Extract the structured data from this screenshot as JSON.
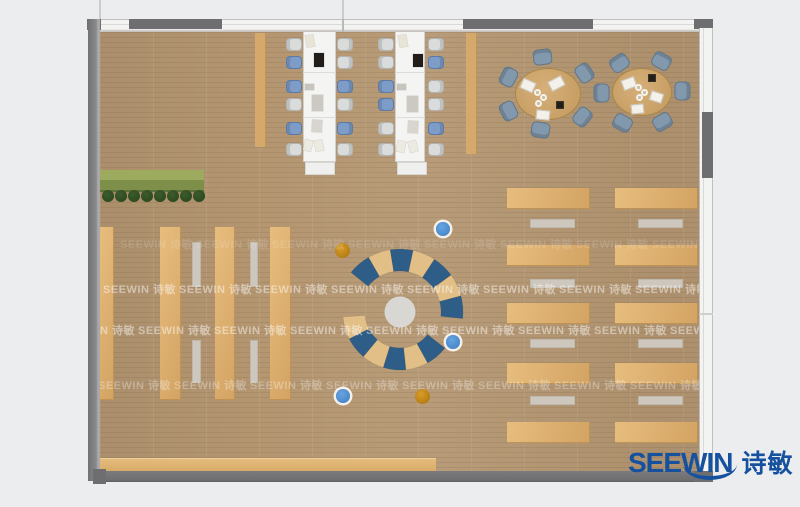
{
  "branding": {
    "logo": {
      "en": "SEEWIN",
      "cn": "诗敏",
      "color": "#15519f"
    },
    "watermark": {
      "text": "SEEWIN 诗敏"
    }
  },
  "palette": {
    "floor": "#b49671",
    "wall_dark": "#6e6e71",
    "window_white": "#f3f3f2",
    "wood_furniture": "#deb170",
    "bench_gray": "#cdc7bd",
    "table_white": "#f4f4f3",
    "chair_blue": "#7e9cc8",
    "chair_gray": "#dadcdb",
    "round_chair_slate": "#8299ad",
    "round_table_tan": "#cfa76f",
    "arc_blue": "#2e5d88",
    "arc_tan": "#e2bf86",
    "center_rug": "#d8d7d3",
    "dot_blue": "#4a8ed2",
    "dot_orange": "#c8860d",
    "planter_green": "#9cab5e",
    "plant_dark": "#27421d"
  },
  "watermark_rows": [
    {
      "y": 236,
      "x0": 120,
      "step": 76,
      "count": 8,
      "opacity": 0.14
    },
    {
      "y": 281,
      "x0": 103,
      "step": 76,
      "count": 8,
      "opacity": 0.46
    },
    {
      "y": 322,
      "x0": 62,
      "step": 76,
      "count": 9,
      "opacity": 0.46
    },
    {
      "y": 377,
      "x0": 98,
      "step": 76,
      "count": 8,
      "opacity": 0.3
    }
  ],
  "furniture": {
    "planter": {
      "x": 100,
      "y": 170,
      "w": 104,
      "h": 22,
      "top": "#9cab5e",
      "bottom": "#7e8f49",
      "edge": "#5f7038"
    },
    "plants": {
      "y": 196,
      "r": 6,
      "xs": [
        108,
        121,
        134,
        147,
        160,
        173,
        186,
        199
      ]
    },
    "shelf_columns": [
      {
        "x": 99,
        "y": 227,
        "w": 15,
        "h": 173
      },
      {
        "x": 160,
        "y": 227,
        "w": 21,
        "h": 173
      },
      {
        "x": 215,
        "y": 227,
        "w": 20,
        "h": 173
      },
      {
        "x": 270,
        "y": 227,
        "w": 21,
        "h": 173
      }
    ],
    "bench_strips": [
      {
        "x": 192,
        "y": 242,
        "w": 9,
        "h": 45
      },
      {
        "x": 250,
        "y": 242,
        "w": 8,
        "h": 45
      },
      {
        "x": 192,
        "y": 340,
        "w": 9,
        "h": 43
      },
      {
        "x": 250,
        "y": 340,
        "w": 8,
        "h": 43
      }
    ],
    "top_strips": [
      {
        "x": 255,
        "y": 33,
        "w": 11,
        "h": 114
      },
      {
        "x": 466,
        "y": 33,
        "w": 11,
        "h": 121
      }
    ],
    "bottom_bench": {
      "x": 100,
      "y": 458,
      "w": 336,
      "h": 13
    },
    "desk_columns": [
      {
        "desk_x": 507,
        "desk_w": 83,
        "strip_x": 530,
        "strip_w": 45
      },
      {
        "desk_x": 615,
        "desk_w": 83,
        "strip_x": 638,
        "strip_w": 45
      }
    ],
    "desk_row_ys": [
      188,
      245,
      303,
      363,
      422
    ],
    "desk_h": 21,
    "strip_row_ys": [
      219,
      279,
      339,
      396
    ],
    "strip_h": 9,
    "long_tables": [
      {
        "x": 303,
        "y": 31,
        "w": 33,
        "h": 131,
        "seams": [
          72,
          117
        ],
        "cap": {
          "x": 305,
          "y": 162,
          "w": 30,
          "h": 13
        },
        "chair_ys": [
          44,
          62,
          86,
          104,
          128,
          149
        ],
        "left_cx": 294,
        "right_cx": 345,
        "left_colors": [
          "gray",
          "blue",
          "blue",
          "gray",
          "blue",
          "gray"
        ],
        "right_colors": [
          "gray",
          "gray",
          "blue",
          "gray",
          "blue",
          "gray"
        ],
        "items": [
          {
            "x": 306,
            "y": 35,
            "w": 8,
            "h": 12,
            "c": "#e8e4d6",
            "r": -10
          },
          {
            "x": 314,
            "y": 53,
            "w": 10,
            "h": 14,
            "c": "#221d18",
            "r": 0
          },
          {
            "x": 305,
            "y": 84,
            "w": 9,
            "h": 6,
            "c": "#c7c4be",
            "r": 0
          },
          {
            "x": 312,
            "y": 95,
            "w": 11,
            "h": 16,
            "c": "#ccc9c3",
            "r": 0
          },
          {
            "x": 312,
            "y": 120,
            "w": 10,
            "h": 12,
            "c": "#d8d5cf",
            "r": 3
          },
          {
            "x": 304,
            "y": 140,
            "w": 8,
            "h": 11,
            "c": "#edebe1",
            "r": 14
          },
          {
            "x": 315,
            "y": 140,
            "w": 8,
            "h": 11,
            "c": "#edebe1",
            "r": -12
          }
        ]
      },
      {
        "x": 395,
        "y": 31,
        "w": 30,
        "h": 131,
        "seams": [
          72,
          117
        ],
        "cap": {
          "x": 397,
          "y": 162,
          "w": 30,
          "h": 13
        },
        "chair_ys": [
          44,
          62,
          86,
          104,
          128,
          149
        ],
        "left_cx": 386,
        "right_cx": 436,
        "left_colors": [
          "gray",
          "gray",
          "blue",
          "blue",
          "gray",
          "gray"
        ],
        "right_colors": [
          "gray",
          "blue",
          "gray",
          "gray",
          "blue",
          "gray"
        ],
        "items": [
          {
            "x": 399,
            "y": 35,
            "w": 8,
            "h": 12,
            "c": "#e8e4d6",
            "r": -10
          },
          {
            "x": 413,
            "y": 54,
            "w": 10,
            "h": 13,
            "c": "#221d18",
            "r": 0
          },
          {
            "x": 397,
            "y": 84,
            "w": 9,
            "h": 6,
            "c": "#c7c4be",
            "r": 0
          },
          {
            "x": 407,
            "y": 96,
            "w": 11,
            "h": 16,
            "c": "#ccc9c3",
            "r": 0
          },
          {
            "x": 408,
            "y": 121,
            "w": 10,
            "h": 12,
            "c": "#d8d5cf",
            "r": 3
          },
          {
            "x": 397,
            "y": 141,
            "w": 8,
            "h": 11,
            "c": "#edebe1",
            "r": 12
          },
          {
            "x": 409,
            "y": 141,
            "w": 8,
            "h": 11,
            "c": "#edebe1",
            "r": -14
          }
        ]
      }
    ],
    "round_tables": [
      {
        "cx": 548,
        "cy": 94,
        "rx": 33,
        "ry": 26,
        "chair_angles": [
          97,
          153,
          207,
          260,
          321,
          34
        ],
        "papers": [
          {
            "x": 521,
            "y": 80,
            "w": 14,
            "h": 11,
            "r": 24
          },
          {
            "x": 549,
            "y": 78,
            "w": 15,
            "h": 11,
            "r": -28
          },
          {
            "x": 536,
            "y": 110,
            "w": 14,
            "h": 10,
            "r": 6
          }
        ],
        "cups": [
          [
            537,
            92
          ],
          [
            543,
            97
          ],
          [
            538,
            103
          ]
        ],
        "dark": {
          "x": 556,
          "y": 101,
          "w": 8,
          "h": 8
        }
      },
      {
        "cx": 642,
        "cy": 92,
        "rx": 30,
        "ry": 24,
        "chair_angles": [
          124,
          61,
          181,
          1,
          241,
          300
        ],
        "papers": [
          {
            "x": 622,
            "y": 78,
            "w": 14,
            "h": 11,
            "r": -20
          },
          {
            "x": 650,
            "y": 92,
            "w": 13,
            "h": 10,
            "r": 18
          },
          {
            "x": 631,
            "y": 104,
            "w": 13,
            "h": 10,
            "r": -6
          }
        ],
        "cups": [
          [
            638,
            87
          ],
          [
            644,
            92
          ],
          [
            639,
            97
          ]
        ],
        "dark": {
          "x": 648,
          "y": 74,
          "w": 8,
          "h": 8
        }
      }
    ],
    "amphitheater": {
      "center_circle": {
        "cx": 400,
        "cy": 312,
        "r": 15.5
      },
      "rings": [
        {
          "cx": 400,
          "cy": 312,
          "r1": 41,
          "r2": 63,
          "a0": -6,
          "a1": 141,
          "colors": [
            "blue",
            "tan",
            "blue",
            "tan",
            "blue",
            "tan",
            "blue"
          ]
        },
        {
          "cx": 400,
          "cy": 313,
          "r1": 35,
          "r2": 57,
          "a0": 184,
          "a1": 322,
          "colors": [
            "tan",
            "blue",
            "tan",
            "blue",
            "tan",
            "blue"
          ]
        }
      ]
    },
    "dots": [
      {
        "cx": 443,
        "cy": 229,
        "r": 7,
        "type": "blue"
      },
      {
        "cx": 453,
        "cy": 342,
        "r": 7,
        "type": "blue"
      },
      {
        "cx": 343,
        "cy": 396,
        "r": 7,
        "type": "blue"
      },
      {
        "cx": 342,
        "cy": 250,
        "r": 7.5,
        "type": "orange"
      },
      {
        "cx": 422,
        "cy": 396,
        "r": 7.5,
        "type": "orange"
      }
    ]
  }
}
